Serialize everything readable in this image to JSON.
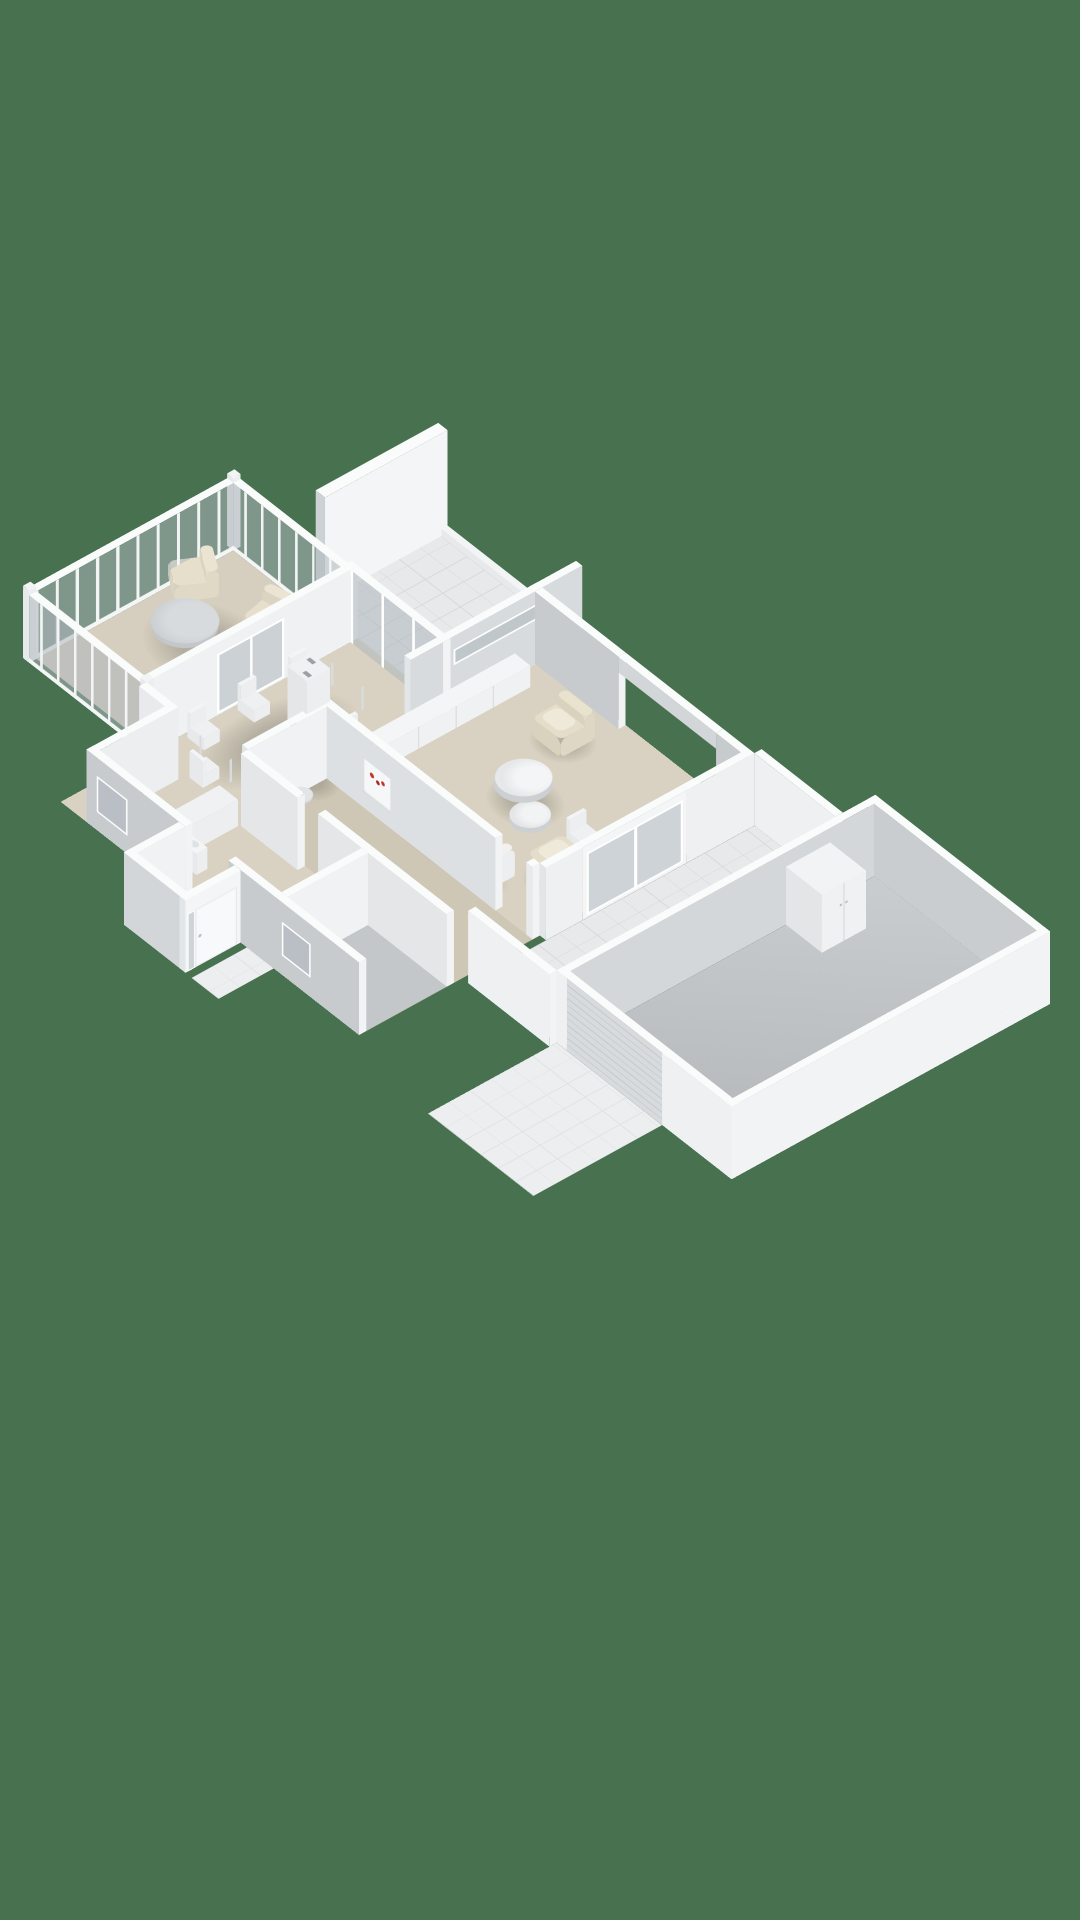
{
  "scene": {
    "title": "isometric-3d-floorplan-render",
    "view": "dollhouse-cutaway-from-southeast",
    "background_color": "#47714F",
    "palette": {
      "bg": "#47714F",
      "wall_top": "#fafbfb",
      "wall_light": "#f2f3f4",
      "wall_gray": "#c7cbce",
      "wall_mid": "#dde0e2",
      "glass": "rgba(173,182,187,0.55)",
      "mullion": "#f3f5f5",
      "floor_beige": "#d9d2c2",
      "floor_taupe": "#cfc7b5",
      "floor_gray": "#c3c7c9",
      "tile": "#e7e9ea",
      "tile_line": "#d5d8da",
      "sofa_white": "#f2f1ed",
      "wood_brown": "#6f4a31",
      "chair_beige": "#e4ddc9",
      "cooktop_black": "#17181a",
      "burner_red": "#c43428",
      "flame_orange": "#ff8c2e",
      "fire_dark": "#241a12"
    },
    "rooms": [
      {
        "name": "conservatory",
        "floor": "beige",
        "walls": "glass-mullion",
        "furniture": [
          "round-table",
          "tub-chair",
          "tub-chair"
        ]
      },
      {
        "name": "patio-north",
        "floor": "white-tiles",
        "features": [
          "tall-chimney-slab"
        ]
      },
      {
        "name": "living-room",
        "floor": "beige",
        "furniture": [
          "sofa-brown-base",
          "armchair",
          "armchair",
          "coffee-table-round",
          "coffee-table-round",
          "sideboard",
          "desk",
          "desk-chair"
        ],
        "features": [
          "slit-window",
          "large-open-window",
          "french-doors-to-terrace",
          "wood-stove-lit"
        ]
      },
      {
        "name": "dining-room",
        "floor": "beige",
        "furniture": [
          "dining-table",
          "dining-chair x6"
        ],
        "features": [
          "glazed-wall-to-patio",
          "glazed-doors-to-conservatory"
        ]
      },
      {
        "name": "kitchen",
        "floor": "beige",
        "furniture": [
          "counter-L",
          "cooktop-4-red-burners"
        ]
      },
      {
        "name": "hallway",
        "floor": "taupe-carpet",
        "furniture": [
          "side-table-round",
          "wall-niche-red-flowers"
        ]
      },
      {
        "name": "utility-room",
        "floor": "beige",
        "furniture": [
          "sink"
        ]
      },
      {
        "name": "bathroom",
        "floor": "gray"
      },
      {
        "name": "entry-porch",
        "floor": "light-tiles",
        "features": [
          "front-door-with-sidelight",
          "tiled-step"
        ]
      },
      {
        "name": "terrace-east",
        "floor": "white-tiles",
        "furniture": [
          "planter-box"
        ]
      },
      {
        "name": "garage",
        "floor": "gray-concrete",
        "furniture": [
          "wardrobe-two-door"
        ],
        "features": [
          "slatted-garage-door"
        ]
      },
      {
        "name": "driveway",
        "floor": "light-tiles"
      }
    ],
    "counts": {
      "burners_on_cooktop": 4,
      "dining_chairs": 6,
      "coffee_tables": 2,
      "armchairs": 2,
      "tub_chairs": 2
    }
  }
}
